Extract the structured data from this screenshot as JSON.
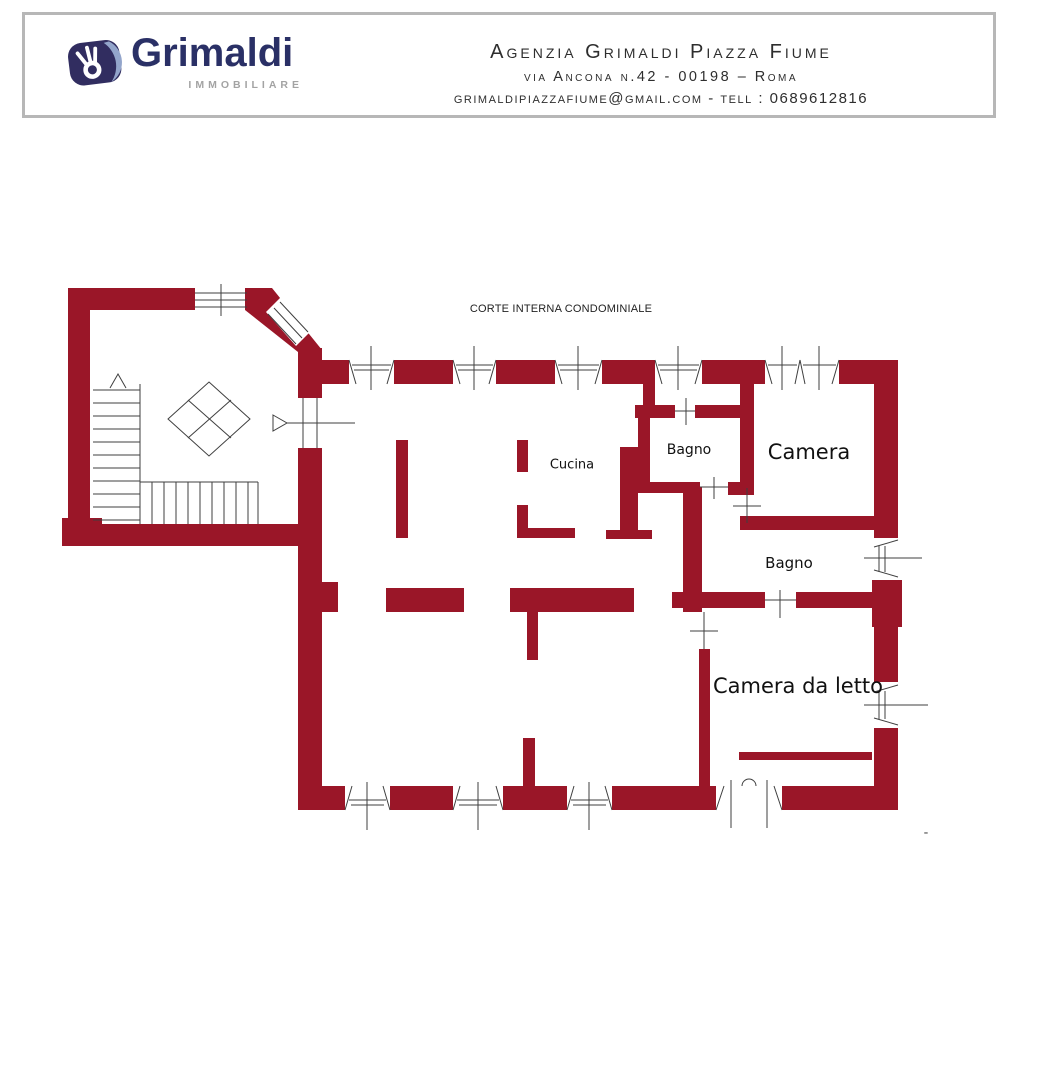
{
  "header": {
    "brand": {
      "name": "Grimaldi",
      "tagline": "IMMOBILIARE",
      "icon": "ok-hand-icon"
    },
    "agency": {
      "line1": "Agenzia Grimaldi Piazza Fiume",
      "line2": "via Ancona n.42  - 00198 – Roma",
      "line3": "grimaldipiazzafiume@gmail.com - tell : 0689612816"
    }
  },
  "floor_plan": {
    "courtyard_label": "CORTE INTERNA CONDOMINIALE",
    "rooms": [
      {
        "id": "cucina",
        "label": "Cucina"
      },
      {
        "id": "bagno-1",
        "label": "Bagno"
      },
      {
        "id": "camera",
        "label": "Camera"
      },
      {
        "id": "bagno-2",
        "label": "Bagno"
      },
      {
        "id": "camera-da-letto",
        "label": "Camera da letto"
      }
    ],
    "page_mark": "-",
    "colors": {
      "wall": "#9a1628",
      "thin_line": "#3f3f3f",
      "brand_navy": "#2a3066",
      "brand_gray": "#a3a3a3"
    }
  }
}
